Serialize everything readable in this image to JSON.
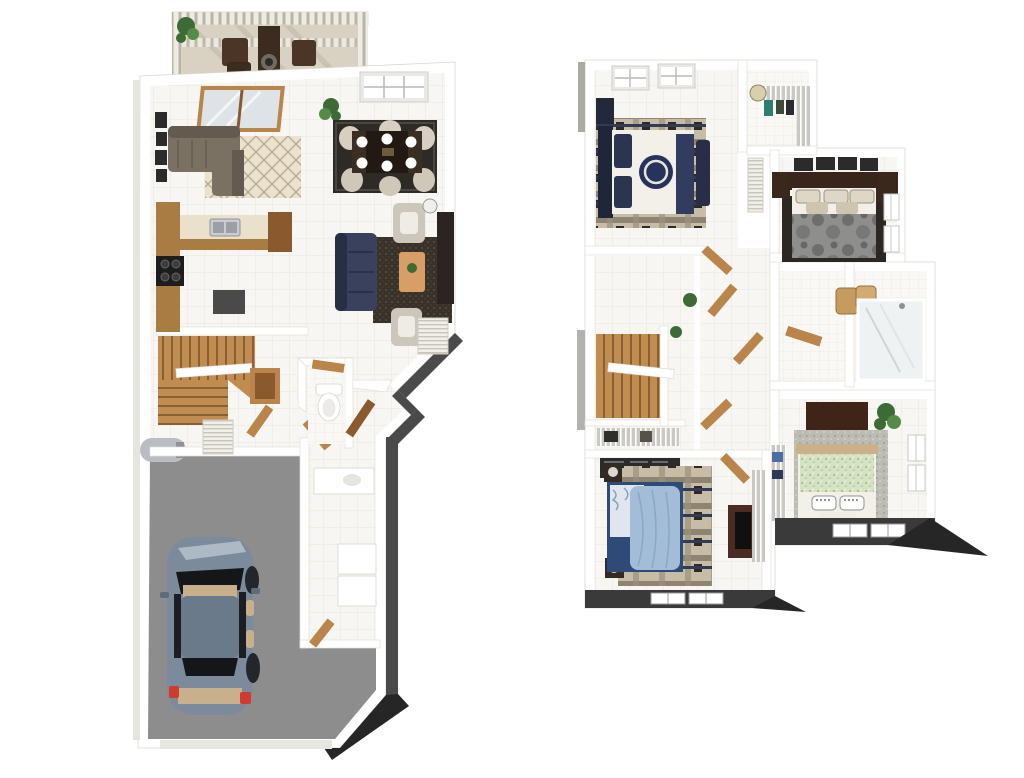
{
  "image": {
    "kind": "3d-floor-plan-render",
    "description": "Two isometric 3D floor plans on white background: first floor with deck, living, dining, kitchen and garage with car (left); second floor with bedrooms and baths (right)",
    "background": "#ffffff",
    "floor_count": 2
  },
  "palette": {
    "wall_top": "#ffffff",
    "wall_side_dark": "#4a4a4a",
    "wall_side_light": "#a9ada1",
    "shadow_wedge": "#262626",
    "tile_floor": "#f8f6f2",
    "tile_line": "#e9e5df",
    "garage_floor": "#8d8d8d",
    "deck_floor": "#d9d2c2",
    "deck_rail": "#efece3",
    "wood": "#b9854b",
    "wood_dark": "#8a5a2e",
    "counter_top": "#eae1cd",
    "sofa_gray": "#7a7163",
    "sofa_navy": "#39415c",
    "rug_cream": "#eae2cf",
    "rug_dark": "#39322a",
    "rug_dining": "#2e2a26",
    "rug_plaid": "#c7bda6",
    "armchair": "#cdc6bb",
    "coffee_table": "#d99e66",
    "tv_console": "#2b2421",
    "cooktop": "#1d1d1d",
    "refrigerator": "#4a4a4a",
    "car_body": "#7c8b9b",
    "car_roof": "#6b7a8a",
    "car_glass": "#15161a",
    "car_interior": "#c8b08c",
    "taillight": "#cf3b2e",
    "water_heater": "#b9bcc0",
    "bed_navy": "#2c3550",
    "bed_white": "#f3f0e9",
    "duvet_gray": "#8e8e8c",
    "bed_blue": "#a3bcd8",
    "bed_green": "#d5e3c3",
    "rug_speckle": "#bcbcb4",
    "wire_shelf": "#d9d7d2",
    "plant": "#3e6b35"
  },
  "floors": [
    {
      "id": "first-floor",
      "position": "left",
      "rooms": [
        {
          "name": "deck",
          "items": [
            "planter-plant",
            "outdoor-armchairs",
            "outdoor-fireplace",
            "slat-railing",
            "pergola"
          ]
        },
        {
          "name": "living-room",
          "items": [
            "gray-sectional-sofa",
            "diamond-rug",
            "gallery-frames",
            "sliding-glass-door"
          ]
        },
        {
          "name": "dining-room",
          "items": [
            "dark-wood-table",
            "six-cream-chairs",
            "dark-rug",
            "grid-window",
            "potted-plant"
          ]
        },
        {
          "name": "family-room",
          "items": [
            "navy-sofa",
            "two-armchairs",
            "wood-coffee-table",
            "dark-rug",
            "tv-console",
            "floor-lamp"
          ]
        },
        {
          "name": "kitchen",
          "items": [
            "l-shaped-counter",
            "double-sink",
            "black-cooktop",
            "refrigerator",
            "wood-cabinets"
          ]
        },
        {
          "name": "staircase",
          "items": [
            "wood-winder-stairs"
          ]
        },
        {
          "name": "powder-room",
          "items": [
            "toilet",
            "wood-vanity"
          ]
        },
        {
          "name": "entry-hall",
          "items": [
            "console-table",
            "louvered-coat-closet",
            "open-wood-doors"
          ]
        },
        {
          "name": "laundry-mudroom",
          "items": [
            "washer",
            "dryer",
            "counter-sink",
            "louvered-closet"
          ]
        },
        {
          "name": "garage",
          "items": [
            "slate-blue-car",
            "water-heater",
            "garage-door-opening"
          ]
        }
      ]
    },
    {
      "id": "second-floor",
      "position": "right",
      "rooms": [
        {
          "name": "bedroom-2",
          "items": [
            "navy-medallion-bed",
            "plaid-rug",
            "dresser",
            "two-skylight-windows",
            "foot-bench"
          ]
        },
        {
          "name": "walk-in-closet",
          "items": [
            "wire-shelving",
            "hanging-clothes",
            "wall-clock"
          ]
        },
        {
          "name": "master-bedroom",
          "items": [
            "gray-floral-bed",
            "four-picture-frames",
            "dark-wood-headboard",
            "nightstands",
            "dark-rug",
            "wall-windows"
          ]
        },
        {
          "name": "hallway",
          "items": [
            "open-wood-doors",
            "louvered-linen-closet",
            "potted-plant"
          ]
        },
        {
          "name": "staircase",
          "items": [
            "wood-winder-stairs",
            "half-wall-railing"
          ]
        },
        {
          "name": "laundry-closet",
          "items": [
            "wire-shelf",
            "supplies"
          ]
        },
        {
          "name": "bathroom",
          "items": [
            "glass-shower",
            "wicker-baskets",
            "tile-floor"
          ]
        },
        {
          "name": "bedroom-3",
          "items": [
            "light-blue-bed",
            "plaid-rug",
            "media-dresser-tv",
            "nightstands-with-lamps",
            "bottom-wall-windows",
            "wire-closet"
          ]
        },
        {
          "name": "bedroom-4",
          "items": [
            "green-speckled-bed",
            "speckled-rug",
            "dark-dresser",
            "potted-plant",
            "wire-closet",
            "wall-windows",
            "bottom-wall-windows"
          ]
        }
      ]
    }
  ]
}
